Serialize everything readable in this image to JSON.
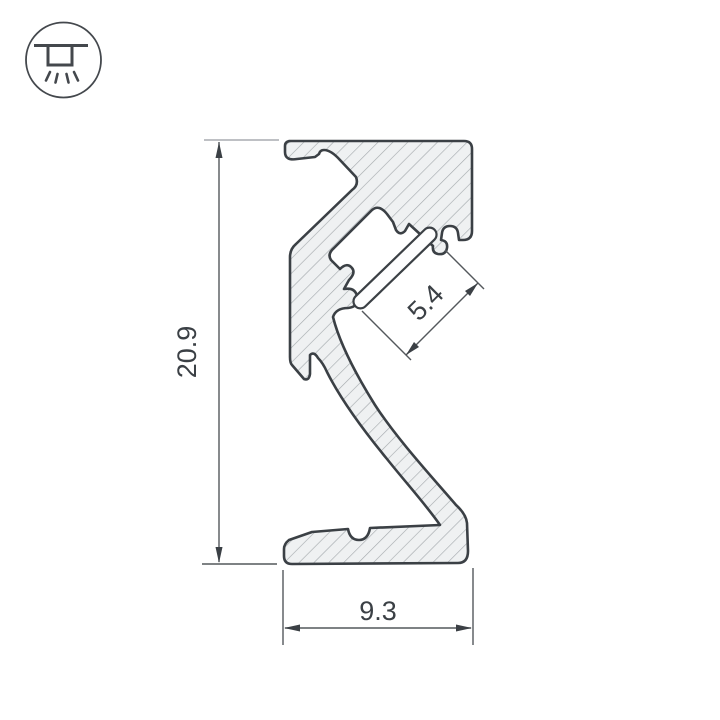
{
  "drawing": {
    "name": "led-profile-cross-section",
    "dim_height": "20.9",
    "dim_slot": "5.4",
    "dim_base": "9.3"
  },
  "icon": {
    "name": "recessed-downlight-icon"
  },
  "colors": {
    "outline": "#3b4045",
    "body_fill": "#eff1f2",
    "hatch_line": "#a4a9ad",
    "dimension_line": "#54585c",
    "extension_light": "#a8acb0",
    "background": "#ffffff"
  }
}
